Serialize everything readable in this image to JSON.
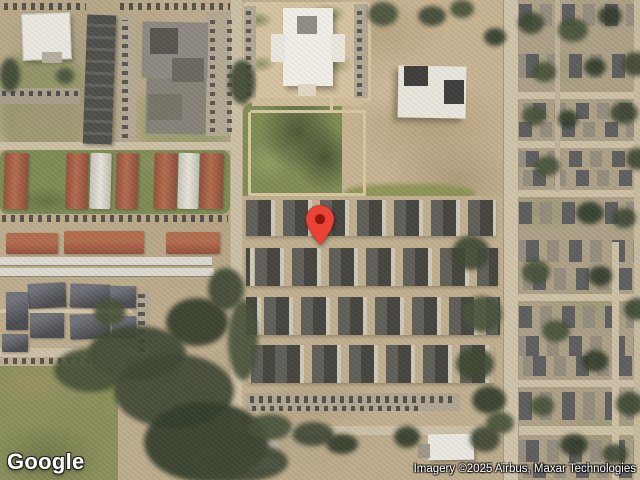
{
  "map": {
    "kind": "satellite-imagery",
    "marker": {
      "name": "location-pin",
      "color": "#EA4335",
      "dot_color": "#8C1A10"
    },
    "logo_text": "Google",
    "attribution_text": "Imagery ©2025 Airbus, Maxar Technologies"
  },
  "colors": {
    "terrain": "#BDAC8D",
    "grass": "#7E8C55",
    "trees": "#3E4734",
    "road": "#CCC0A6",
    "red_roof": "#A65A42",
    "dark_roof": "#4C4B47",
    "white_building": "#EAE8E1",
    "marker_red": "#EA4335"
  }
}
